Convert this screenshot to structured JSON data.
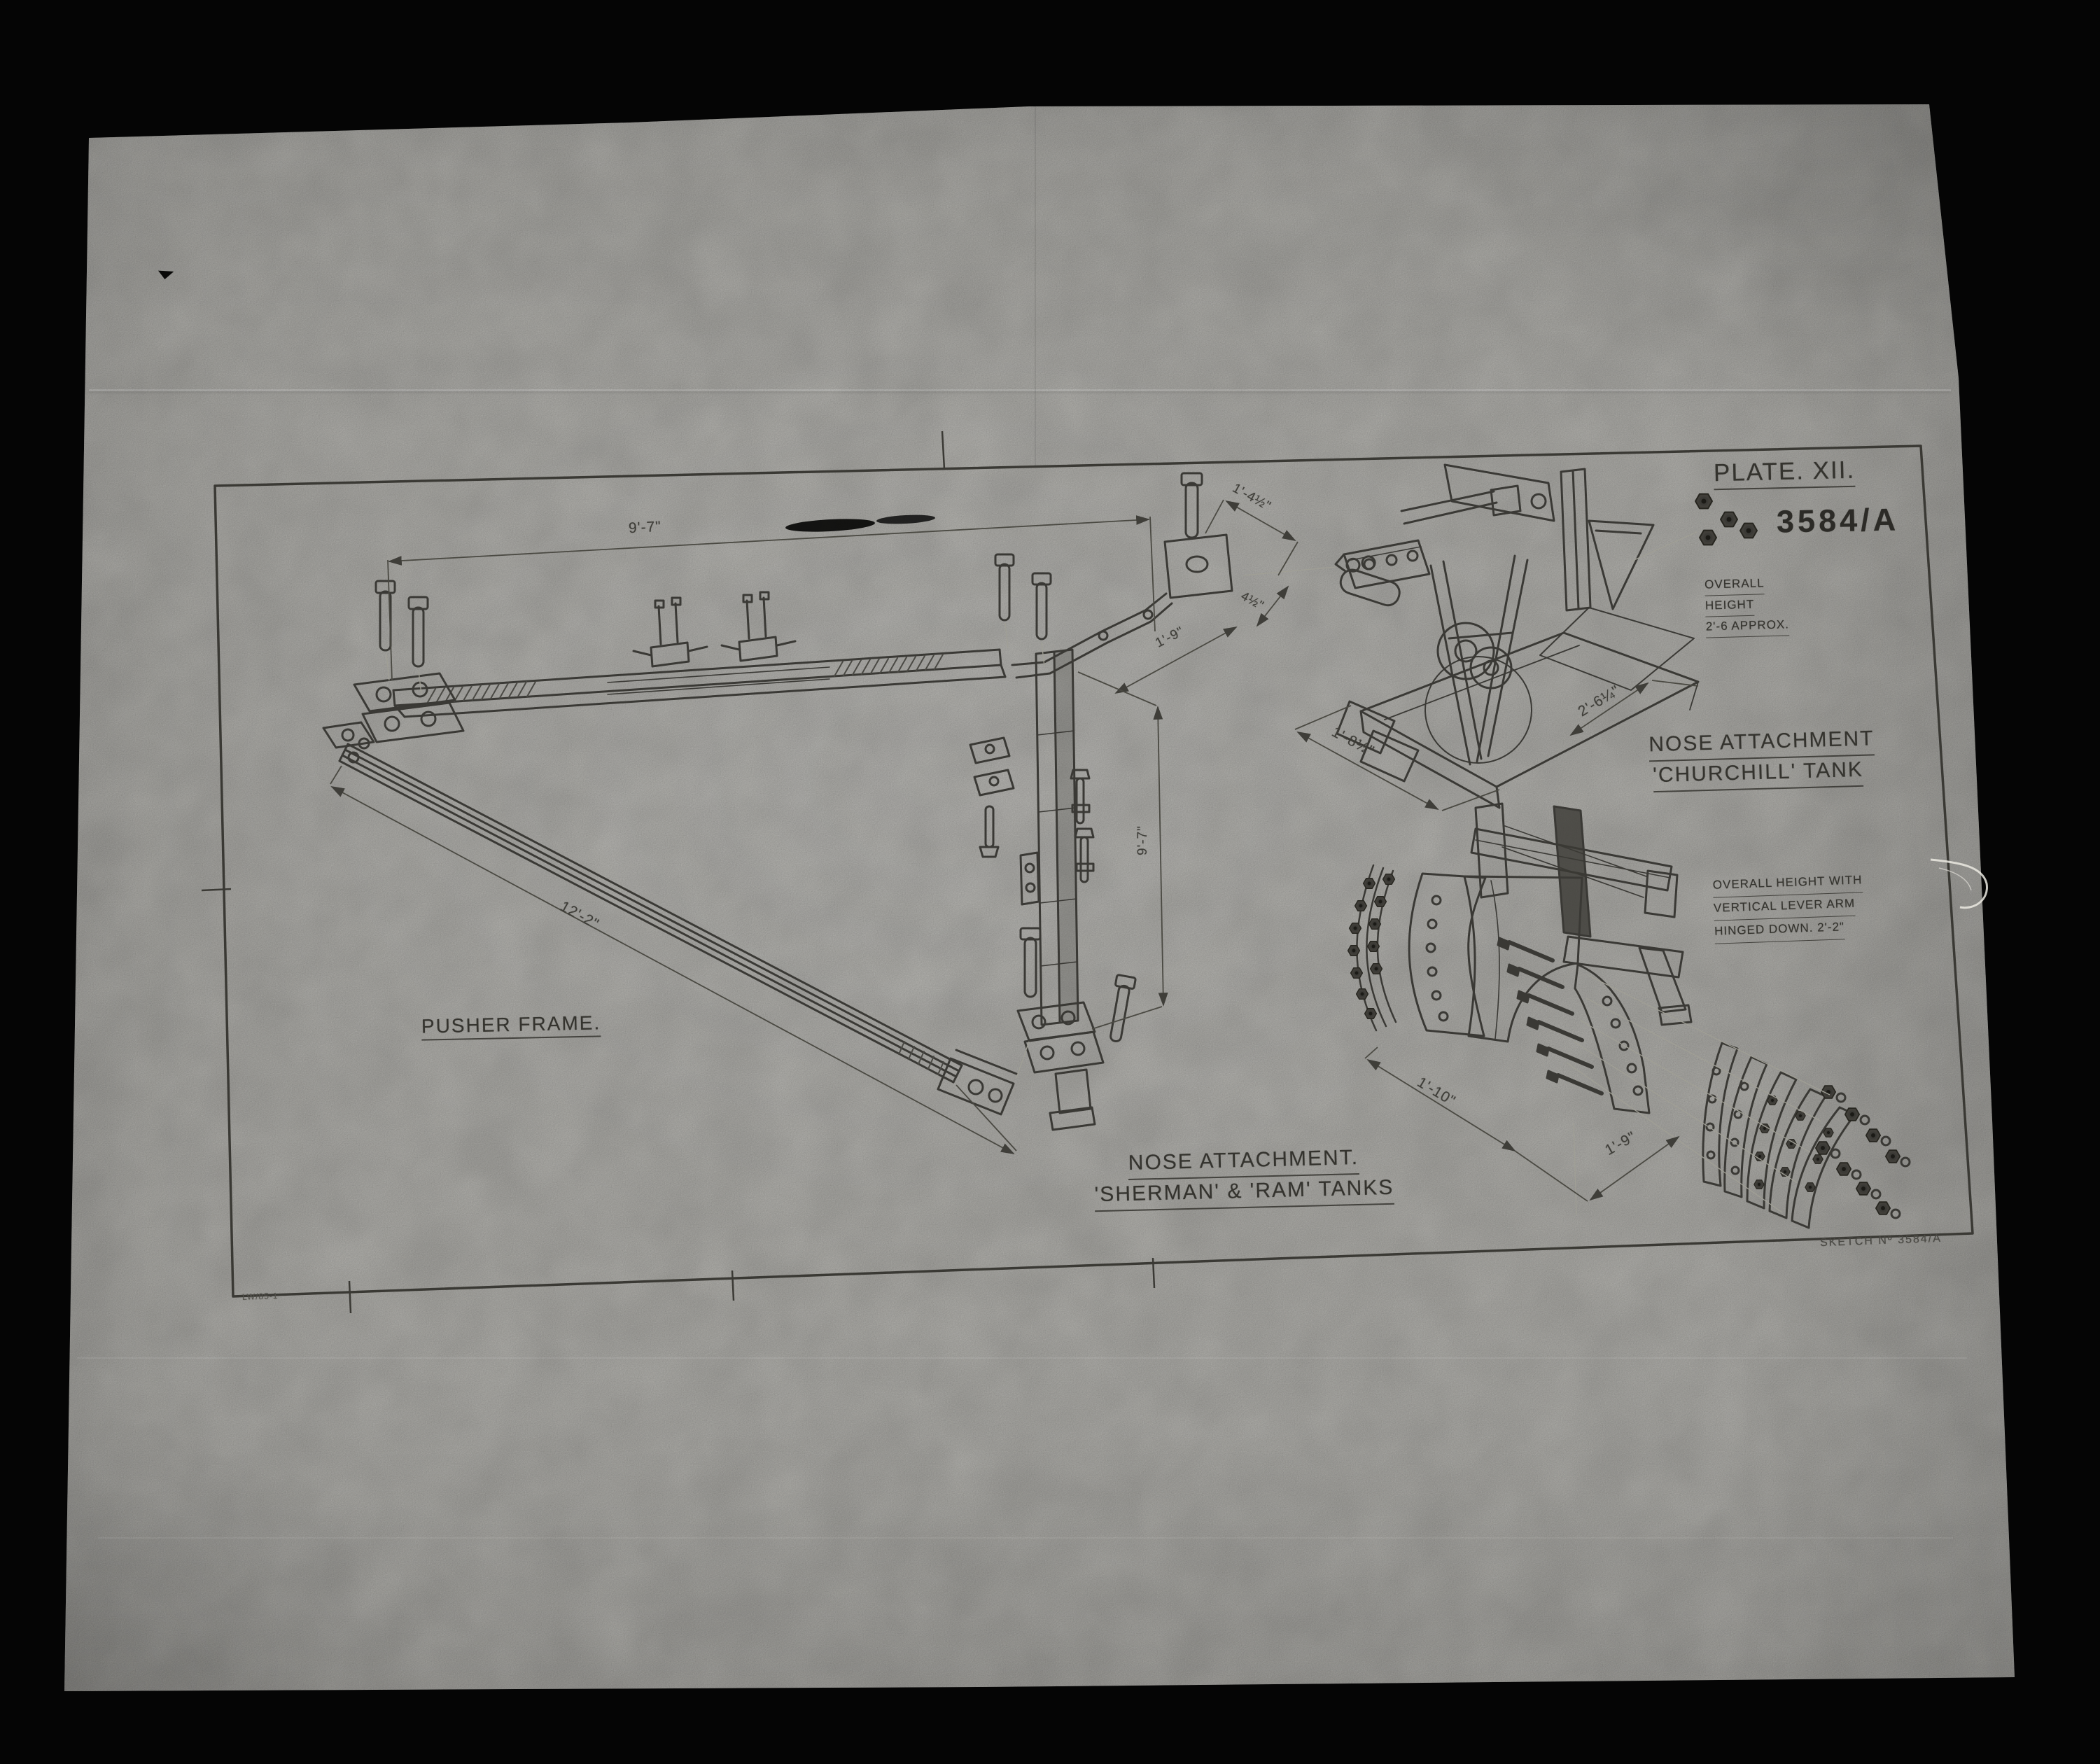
{
  "drawing": {
    "plate_label": "PLATE. XII.",
    "drawing_number": "3584/A",
    "sketch_number": "SKETCH Nº 3584/A",
    "corner_mark": "LW/85-1"
  },
  "labels": {
    "pusher_frame": "PUSHER FRAME.",
    "churchill_line1": "NOSE ATTACHMENT",
    "churchill_line2": "'CHURCHILL' TANK",
    "sherman_line1": "NOSE ATTACHMENT.",
    "sherman_line2": "'SHERMAN' & 'RAM' TANKS"
  },
  "notes": {
    "churchill_height_line1": "OVERALL",
    "churchill_height_line2": "HEIGHT",
    "churchill_height_line3": "2'-6 APPROX.",
    "lever_line1": "OVERALL HEIGHT WITH",
    "lever_line2": "VERTICAL LEVER ARM",
    "lever_line3": "HINGED DOWN. 2'-2\""
  },
  "dimensions": {
    "pusher_top": "9'-7\"",
    "pusher_diagonal": "12'-2\"",
    "link_width": "1'-4½\"",
    "link_offset": "4½\"",
    "bracket": "1'-9\"",
    "link_vertical": "9'-7\"",
    "churchill_depth": "1'-8½\"",
    "churchill_width": "2'-6¼\"",
    "sherman_depth": "1'-10\"",
    "sherman_width": "1'-9\""
  },
  "colors": {
    "paper": "#c7c6c1",
    "ink": "#34332e",
    "background": "#050505"
  }
}
